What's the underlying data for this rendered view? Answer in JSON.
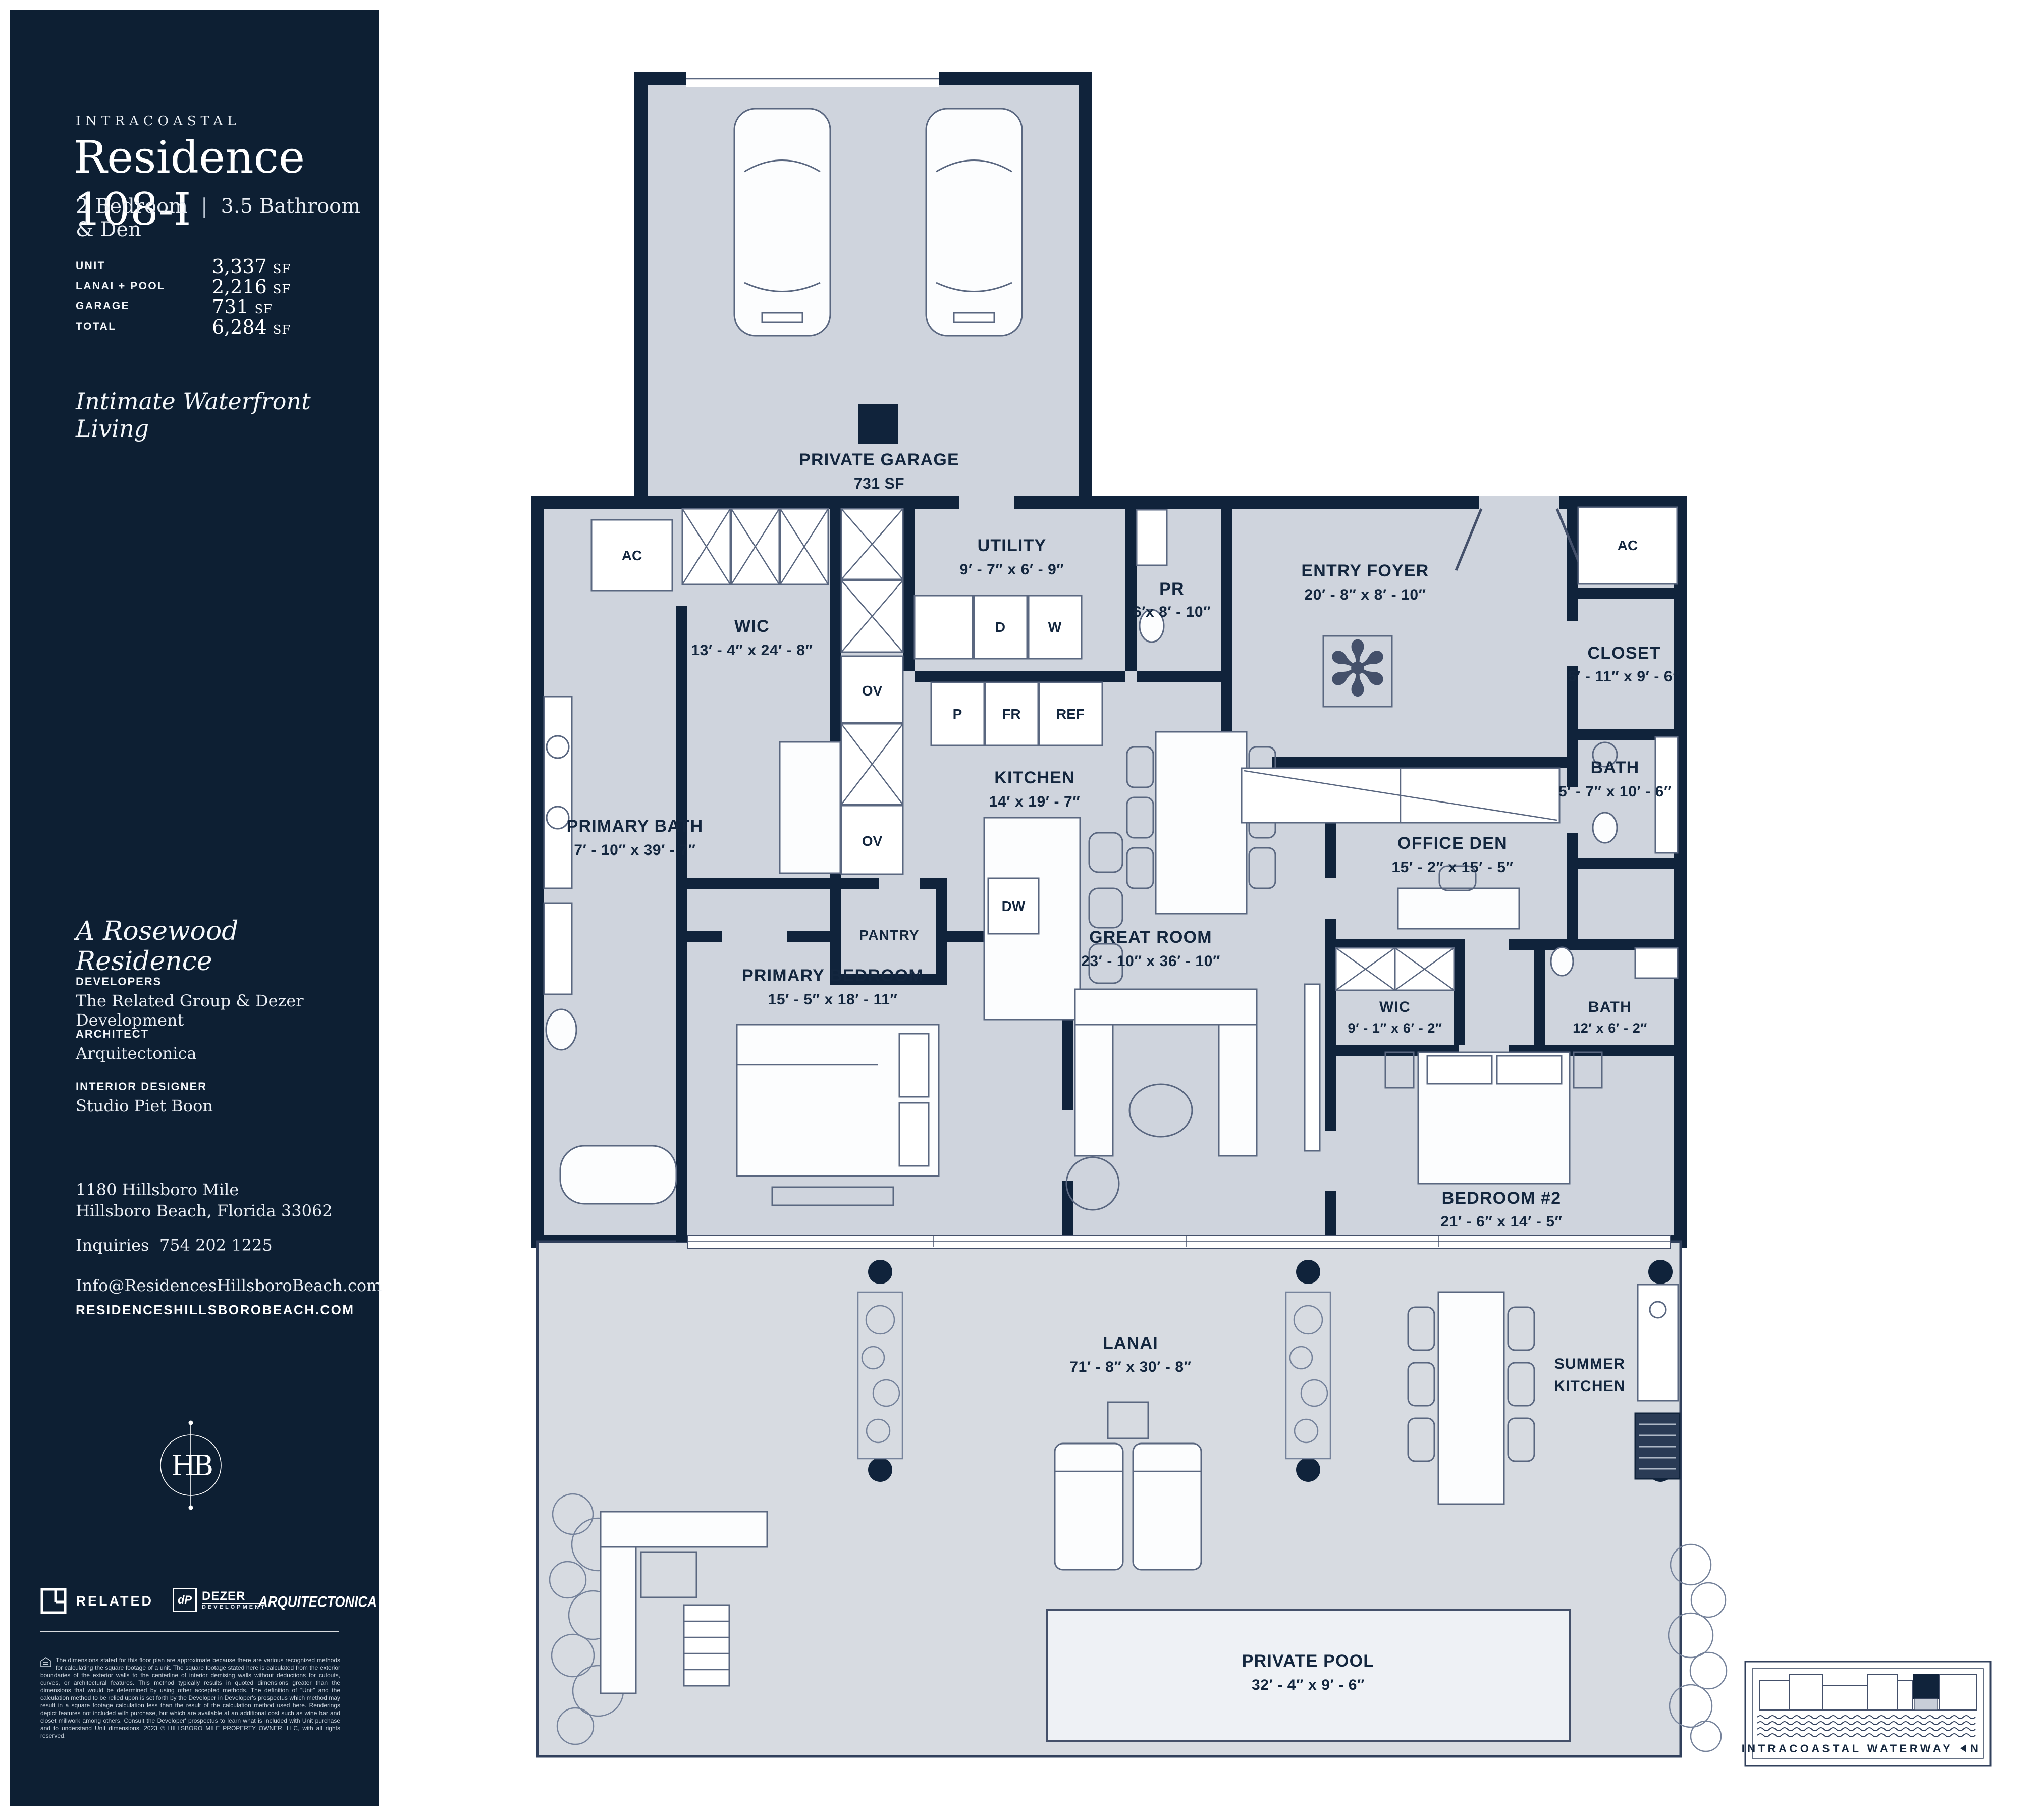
{
  "sidebar": {
    "eyebrow": "INTRACOASTAL",
    "title": "Residence 108-I",
    "bedrooms": "2 Bedroom",
    "separator": "|",
    "baths": "3.5 Bathroom & Den",
    "stats": [
      {
        "label": "UNIT",
        "value": "3,337",
        "unit": "SF"
      },
      {
        "label": "LANAI + POOL",
        "value": "2,216",
        "unit": "SF"
      },
      {
        "label": "GARAGE",
        "value": "731",
        "unit": "SF"
      },
      {
        "label": "TOTAL",
        "value": "6,284",
        "unit": "SF"
      }
    ],
    "tagline": "Intimate Waterfront Living",
    "collection": "A Rosewood Residence",
    "credits": [
      {
        "label": "DEVELOPERS",
        "value": "The Related Group & Dezer Development"
      },
      {
        "label": "ARCHITECT",
        "value": "Arquitectonica"
      },
      {
        "label": "INTERIOR DESIGNER",
        "value": "Studio Piet Boon"
      }
    ],
    "address1": "1180 Hillsboro Mile",
    "address2": "Hillsboro Beach, Florida 33062",
    "inquiries_label": "Inquiries",
    "inquiries_phone": "754 202 1225",
    "email": "Info@ResidencesHillsboroBeach.com",
    "website": "RESIDENCESHILLSBOROBEACH.COM",
    "monogram": "HB",
    "logos": {
      "related": "RELATED",
      "dezer_mark": "dP",
      "dezer": "DEZER",
      "dezer_sub": "DEVELOPMENT",
      "arquitectonica": "ARQUITECTONICA"
    },
    "disclaimer": "The dimensions stated for this floor plan are approximate because there are various recognized methods for calculating the square footage of a unit. The square footage stated here is calculated from the exterior boundaries of the exterior walls to the centerline of interior demising walls without deductions for cutouts, curves, or architectural features. This method typically results in quoted dimensions greater than the dimensions that would be determined by using other accepted methods. The definition of “Unit” and the calculation method to be relied upon is set forth by the Developer in Developer's prospectus which method may result in a square footage calculation less than the result of the calculation method used here. Renderings depict features not included with purchase, but which are available at an additional cost such as wine bar and closet millwork among others. Consult the Developer' prospectus to learn what is included with Unit purchase and to understand Unit dimensions. 2023 © HILLSBORO MILE PROPERTY OWNER, LLC, with all rights reserved."
  },
  "plan": {
    "garage": {
      "name": "PRIVATE GARAGE",
      "area": "731 SF"
    },
    "wic_primary": {
      "name": "WIC",
      "dims": "13′ - 4″ x 24′ - 8″"
    },
    "utility": {
      "name": "UTILITY",
      "dims": "9′ - 7″ x 6′ - 9″"
    },
    "powder": {
      "name": "PR",
      "dims": "6′x 8′ - 10″"
    },
    "entry": {
      "name": "ENTRY FOYER",
      "dims": "20′ - 8″ x 8′ - 10″"
    },
    "closet": {
      "name": "CLOSET",
      "dims": "5′ - 11″ x 9′ - 6″"
    },
    "bath_guest": {
      "name": "BATH",
      "dims": "5′ - 7″ x 10′ - 6″"
    },
    "kitchen": {
      "name": "KITCHEN",
      "dims": "14′ x 19′ - 7″"
    },
    "office": {
      "name": "OFFICE DEN",
      "dims": "15′ - 2″ x 15′ - 5″"
    },
    "primary_bath": {
      "name": "PRIMARY BATH",
      "dims": "7′ - 10″ x 39′ - 7″"
    },
    "pantry": {
      "name": "PANTRY"
    },
    "great_room": {
      "name": "GREAT ROOM",
      "dims": "23′ - 10″ x 36′ - 10″"
    },
    "primary_bedroom": {
      "name": "PRIMARY BEDROOM",
      "dims": "15′ - 5″ x 18′ - 11″"
    },
    "wic_2": {
      "name": "WIC",
      "dims": "9′ - 1″ x 6′ - 2″"
    },
    "bath_2": {
      "name": "BATH",
      "dims": "12′ x 6′ - 2″"
    },
    "bedroom_2": {
      "name": "BEDROOM #2",
      "dims": "21′ - 6″ x 14′ - 5″"
    },
    "lanai": {
      "name": "LANAI",
      "dims": "71′ - 8″ x 30′ - 8″"
    },
    "summer_kitchen": {
      "line1": "SUMMER",
      "line2": "KITCHEN"
    },
    "pool": {
      "name": "PRIVATE POOL",
      "dims": "32′ - 4″ x 9′ - 6″"
    },
    "ac": "AC",
    "appliances": {
      "d": "D",
      "w": "W",
      "p": "P",
      "fr": "FR",
      "ref": "REF",
      "ov": "OV",
      "dw": "DW"
    },
    "minimap": {
      "label": "INTRACOASTAL WATERWAY",
      "north": "N"
    }
  },
  "colors": {
    "navy": "#0D1F33",
    "plan_fill": "#CFD4DD",
    "lanai_fill": "#D7DBE1",
    "pool_fill": "#EEF1F5",
    "text_navy": "#13263E"
  }
}
